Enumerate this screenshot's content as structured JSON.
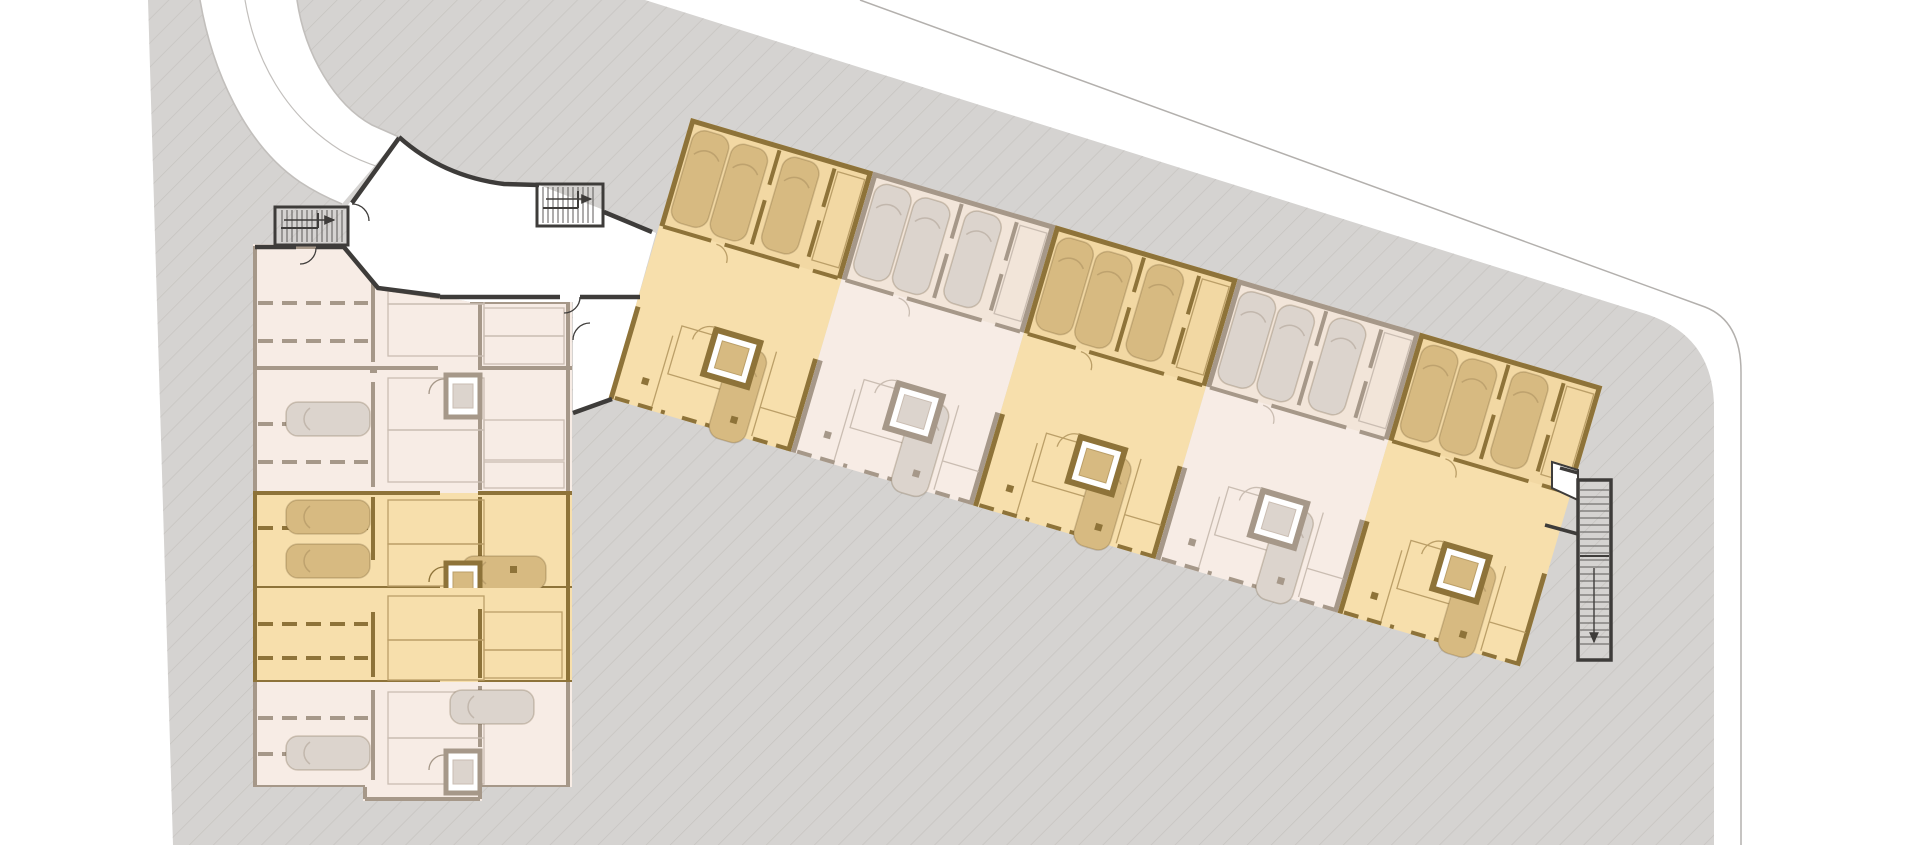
{
  "app": {
    "view_type": "site-floor-plan",
    "visible_text": [],
    "description_of_pixels": "Top-down architectural basement/garage floor plan of a two-wing apartment building on a hatched site, with highlighted and muted unit modules, parking bays with cars, elevators, stairwells and a curved access road entering from the top-left."
  },
  "palette": {
    "hl-fill": "#f7dfac",
    "hl-wall": "#8e7339",
    "hl-car": "#d7ba81",
    "hl-thin": "#bb9f68",
    "mut-fill": "#f7ece5",
    "mut-wall": "#a69889",
    "mut-car": "#dcd4cd",
    "mut-thin": "#cabdb2",
    "dark": "#3e3c3a",
    "site": "#d5d3d1",
    "hatch": "#c6c3c0",
    "bline": "#b3b0ad",
    "road": "#c2bfbc",
    "background": "#ffffff"
  },
  "site": {
    "ground": "diagonal-hatched gray plot with rounded top-right corner",
    "boundary_line": "thin gray property line running parallel outside the top-right edge",
    "road": "white curved access road entering at top-left"
  },
  "buildings": {
    "left_wing": {
      "orientation": "vertical",
      "rows": [
        {
          "id": "A1",
          "state": "muted"
        },
        {
          "id": "A2",
          "state": "muted"
        },
        {
          "id": "A3",
          "state": "highlighted"
        },
        {
          "id": "A4",
          "state": "highlighted"
        },
        {
          "id": "A5",
          "state": "muted"
        }
      ]
    },
    "diagonal_wing": {
      "orientation": "rotated",
      "angle_deg": 16.4,
      "modules": [
        {
          "id": "B1",
          "state": "highlighted"
        },
        {
          "id": "B2",
          "state": "muted"
        },
        {
          "id": "B3",
          "state": "highlighted"
        },
        {
          "id": "B4",
          "state": "muted"
        },
        {
          "id": "B5",
          "state": "highlighted"
        }
      ]
    }
  },
  "features": {
    "entrance_stairwells": 2,
    "exterior_stairwell": 1,
    "elevators": 8,
    "icons": [
      "car-glyph",
      "elevator-icon",
      "stair-treads",
      "stair-direction-arrow"
    ]
  }
}
